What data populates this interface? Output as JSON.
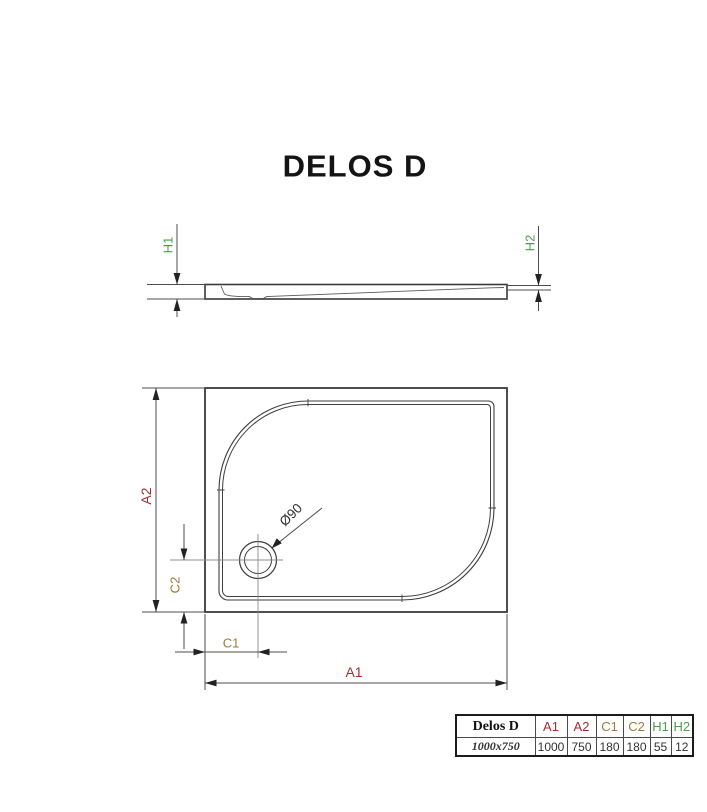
{
  "title": "DELOS D",
  "side_view": {
    "h1_label": "H1",
    "h2_label": "H2"
  },
  "top_view": {
    "a1_label": "A1",
    "a2_label": "A2",
    "c1_label": "C1",
    "c2_label": "C2",
    "drain_label": "Ø90"
  },
  "colors": {
    "a_dimension": "#a03030",
    "c_dimension": "#9a7c3c",
    "h_dimension": "#4a9d4a",
    "drawing_line": "#3a3a3a"
  },
  "spec_table": {
    "header": [
      "Delos D",
      "A1",
      "A2",
      "C1",
      "C2",
      "H1",
      "H2"
    ],
    "row": [
      "1000x750",
      "1000",
      "750",
      "180",
      "180",
      "55",
      "12"
    ]
  }
}
